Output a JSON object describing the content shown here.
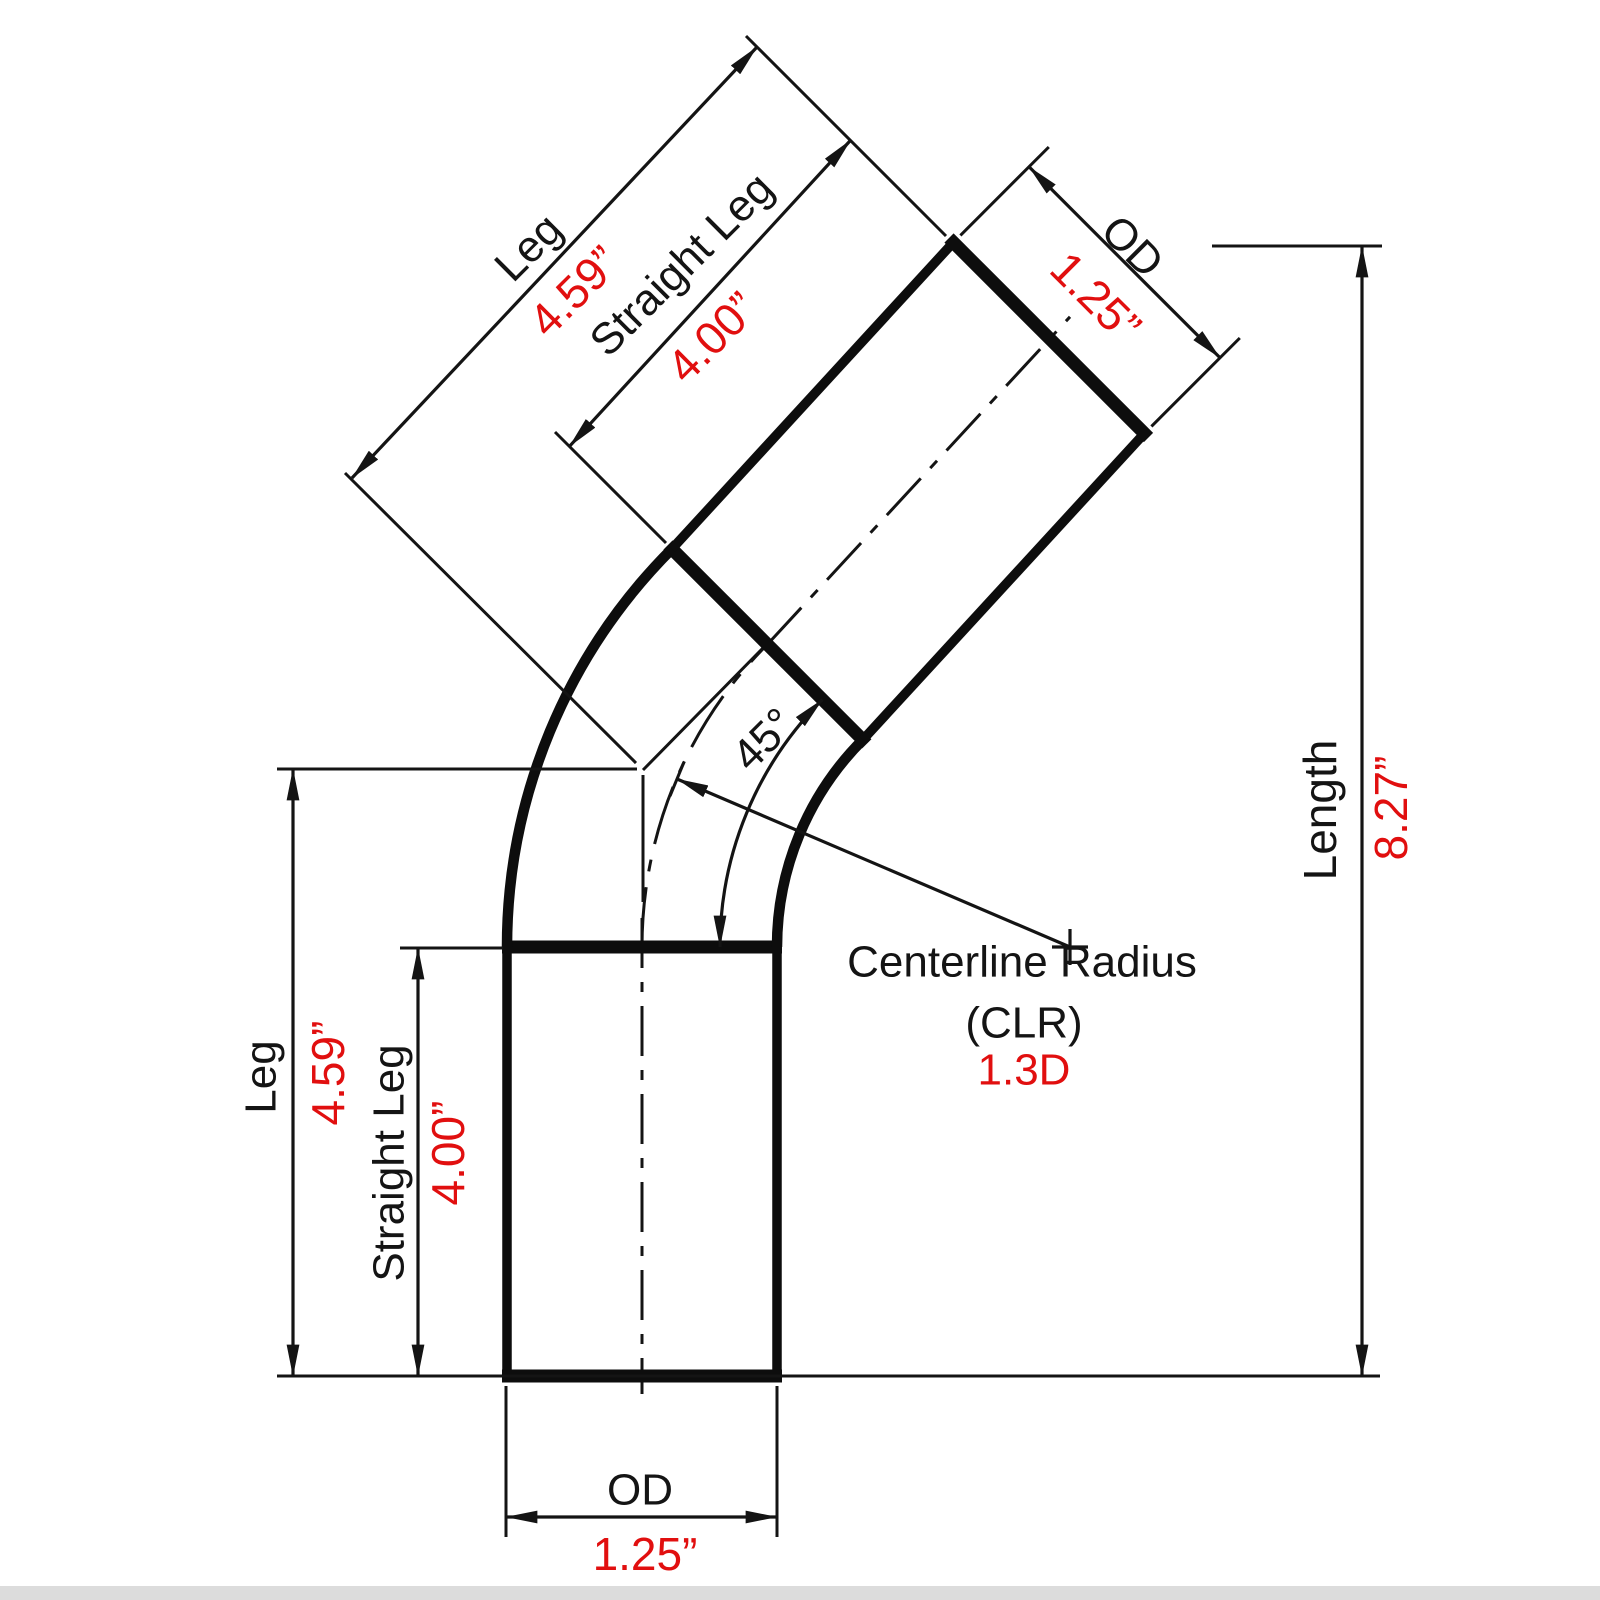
{
  "diagram": {
    "type": "technical-drawing",
    "subject": "45-degree mandrel pipe bend with dimensions",
    "colors": {
      "line": "#141414",
      "value_text": "#e10f0f",
      "background": "#ffffff"
    },
    "dimensions": {
      "upper_leg": {
        "label": "Leg",
        "value": "4.59”"
      },
      "upper_straight_leg": {
        "label": "Straight Leg",
        "value": "4.00”"
      },
      "upper_od": {
        "label": "OD",
        "value": "1.25”"
      },
      "length": {
        "label": "Length",
        "value": "8.27”"
      },
      "angle": {
        "value": "45°"
      },
      "centerline_radius": {
        "label_line1": "Centerline Radius",
        "label_line2": "(CLR)",
        "value": "1.3D"
      },
      "lower_leg": {
        "label": "Leg",
        "value": "4.59”"
      },
      "lower_straight_leg": {
        "label": "Straight Leg",
        "value": "4.00”"
      },
      "lower_od": {
        "label": "OD",
        "value": "1.25”"
      }
    }
  }
}
